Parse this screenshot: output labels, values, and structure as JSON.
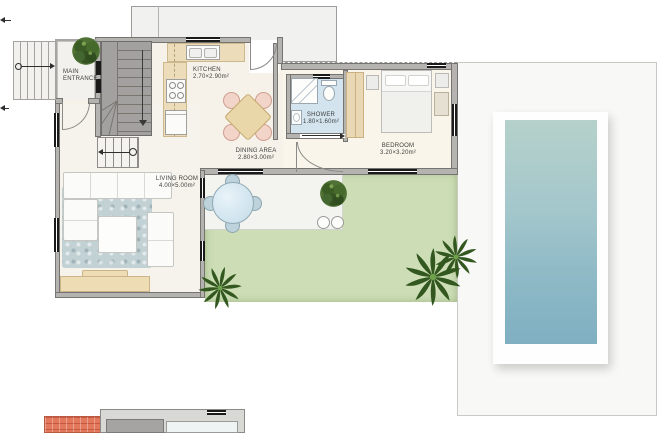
{
  "floor_plan": {
    "rooms": {
      "main_entrance": {
        "line1": "MAIN",
        "line2": "ENTRANCE"
      },
      "kitchen": {
        "name": "KITCHEN",
        "dims": "2.70×2.90m²"
      },
      "dining_area": {
        "name": "DINING AREA",
        "dims": "2.80×3.00m²"
      },
      "shower": {
        "name": "SHOWER",
        "dims": "1.80×1.60m²"
      },
      "bedroom": {
        "name": "BEDROOM",
        "dims": "3.20×3.20m²"
      },
      "living_room": {
        "name": "LIVING ROOM",
        "dims": "4.00×5.00m²"
      }
    },
    "icons": {
      "tree": "round-canopy-top-view",
      "palm_tree": "radial-fronds-top-view",
      "entry_arrow": "→",
      "stair_down_arrow": "↓",
      "stair_left_arrow": "←",
      "shower_slide_arrow": "→"
    },
    "colors": {
      "lawn": "#cddeb6",
      "pool_water_top": "#b5d1ca",
      "pool_water_bottom": "#7fafc2",
      "wall": "#b5b3b0",
      "kitchen_counter": "#ecdcba",
      "shower_floor": "#d3e4ee",
      "stairs": "#a3a1a0",
      "roof_tiles": "#e2795c",
      "rug": "#c2d1d4",
      "wood_furniture": "#ead8b5"
    }
  }
}
